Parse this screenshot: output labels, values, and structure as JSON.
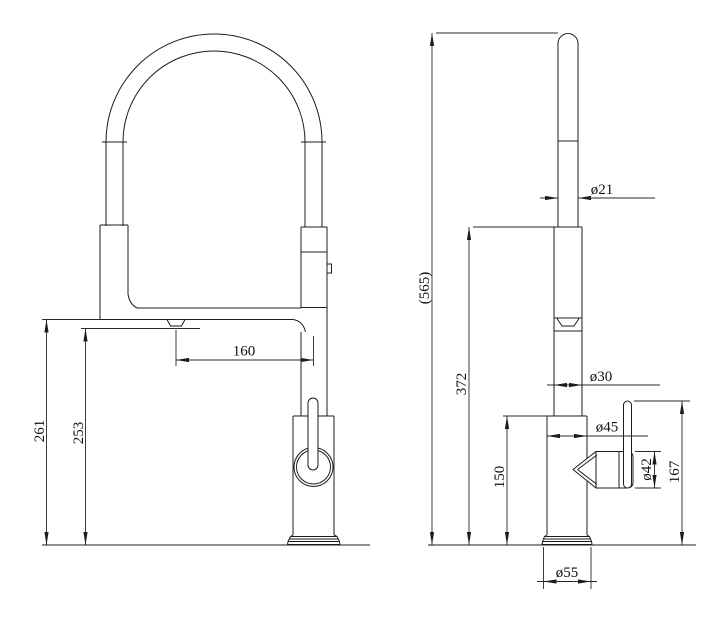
{
  "canvas": {
    "background_color": "#ffffff",
    "line_color": "#1c1c1c",
    "drawing_type": "faucet dimensional drawing"
  },
  "front_view": {
    "dims": {
      "spout_reach": "160",
      "spout_height": "261",
      "outlet_height": "253"
    }
  },
  "side_view": {
    "dims": {
      "overall_height": "(565)",
      "spray_head_height": "372",
      "body_height": "150",
      "handle_height": "167",
      "spout_tube_diameter": "ø21",
      "riser_diameter": "ø30",
      "body_diameter": "ø45",
      "handle_diameter": "ø42",
      "base_diameter": "ø55"
    }
  }
}
